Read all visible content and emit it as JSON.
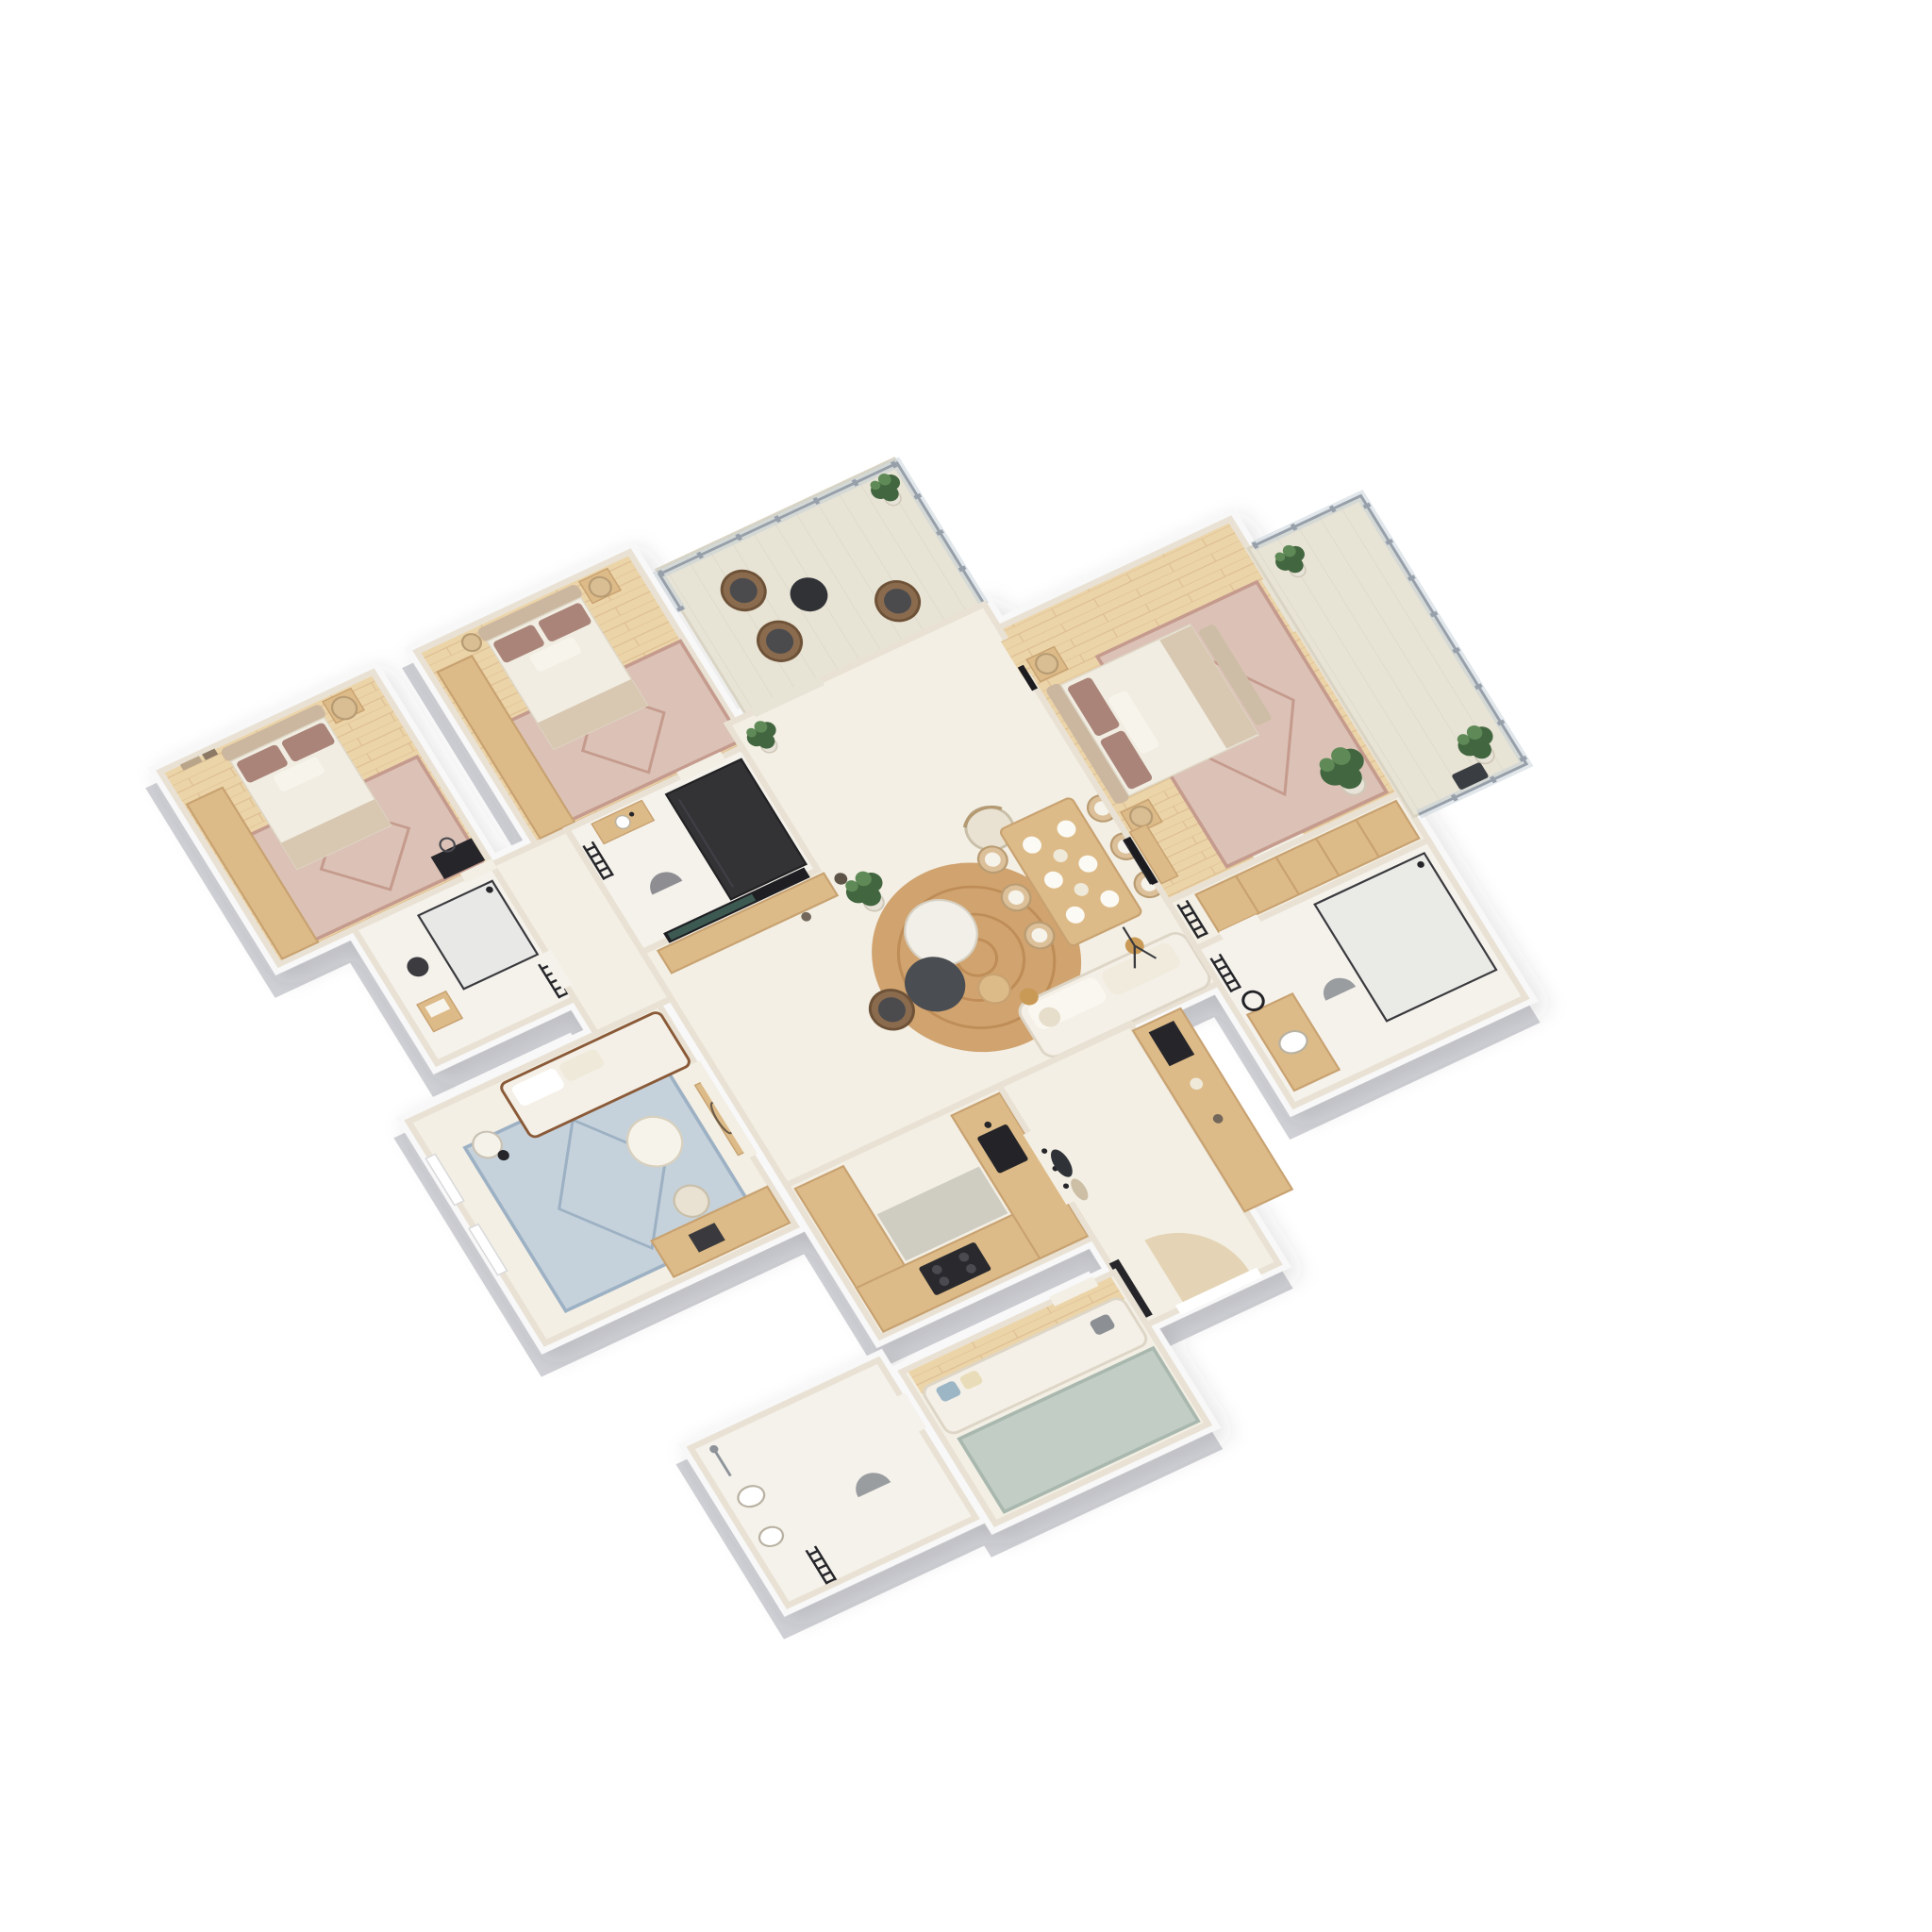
{
  "meta": {
    "title": "3D floor plan — three-bedroom apartment (isometric render)",
    "type": "architectural visualization",
    "style": "photoreal 3D cutaway floor plan on white background",
    "text_labels": []
  },
  "colors": {
    "page": "#ffffff",
    "wall": "#f8f8f9",
    "wallSide": "#d0d1d6",
    "wallFace": "#e9e2d4",
    "floor": "#f3efe4",
    "bathFloor": "#f5f2ec",
    "wood": "#ecd4a9",
    "woodLine": "#ddbf92",
    "counter": "#ddbb88",
    "counterSide": "#c8a271",
    "counterLow": "#cfccc2",
    "rugPink": "#dcc2b6",
    "rugPinkDeep": "#c59b8e",
    "rugBlue": "#c6d2db",
    "rugBlueDeep": "#9db1c4",
    "rugSage": "#c2cdc6",
    "rugSageDeep": "#a9b8af",
    "jute": "#d0a36f",
    "juteDeep": "#bf8d57",
    "sofa": "#f4f0e7",
    "sofaEdge": "#ddd5c6",
    "bedWhite": "#f1ede2",
    "bedBeige": "#d8c8b2",
    "headboard": "#cbb79f",
    "pillow": "#aa8478",
    "dark": "#26262a",
    "railing": "#97a0aa",
    "railGlass": "#c3cfd7",
    "plant": "#42663f",
    "plantLight": "#5f8a57",
    "balcony": "#e7e3d5",
    "balconyLine": "#d9d4c4",
    "doorArc": "#dcc49b",
    "chairTan": "#dcc09a",
    "wicker": "#8a6b4e",
    "cushionDark": "#4b4b4e",
    "brass": "#c99a56",
    "tvScreen": "#3d5a52"
  },
  "stats": {
    "bedrooms": 3,
    "bathrooms": 3,
    "balconies": 2,
    "floors_shown": 1
  },
  "rooms": [
    {
      "id": "bedroom-1",
      "name": "Bedroom 1",
      "floor": "wood",
      "furniture": [
        "wardrobe",
        "double bed with mauve pillows",
        "oriental rug",
        "nightstand",
        "drum pendant lamp",
        "wall art",
        "dark vanity with mirror"
      ]
    },
    {
      "id": "bathroom-1",
      "name": "Bathroom 1",
      "floor": "tile",
      "furniture": [
        "glass walk-in shower",
        "towel ladder",
        "wooden stool with towels",
        "round mat"
      ]
    },
    {
      "id": "home-office",
      "name": "Home office",
      "floor": "cream",
      "furniture": [
        "daybed sofa",
        "blue oriental rug",
        "round coffee table",
        "floor lamp",
        "desk with laptop",
        "office chair",
        "console with mirror",
        "windows"
      ]
    },
    {
      "id": "bedroom-2",
      "name": "Bedroom 2",
      "floor": "wood",
      "furniture": [
        "wardrobe",
        "double bed with mauve pillows",
        "oriental rug",
        "nightstand",
        "drum pendant lamps"
      ]
    },
    {
      "id": "bathroom-2",
      "name": "Bathroom 2",
      "floor": "tile",
      "furniture": [
        "dark glass shower cabin",
        "vanity sink",
        "towel ladder",
        "round mat"
      ]
    },
    {
      "id": "balcony-1",
      "name": "Balcony 1",
      "floor": "decking",
      "furniture": [
        "metal railing",
        "two wicker armchairs",
        "extra wicker chair",
        "round black side table",
        "potted plant"
      ]
    },
    {
      "id": "living-room",
      "name": "Living / dining room",
      "floor": "cream",
      "furniture": [
        "TV console with landscape TV",
        "decor vases",
        "fiddle-leaf fig plants",
        "round jute rug",
        "white sofa",
        "marble coffee table",
        "charcoal coffee table",
        "wood side table",
        "brass side table",
        "lounge armchair",
        "wicker armchair",
        "tripod floor lamp",
        "dining table for six",
        "six dining chairs",
        "table settings",
        "wall art"
      ]
    },
    {
      "id": "kitchen",
      "name": "Kitchen",
      "floor": "cream",
      "furniture": [
        "U-shaped oak counter",
        "lower prep top",
        "cooktop",
        "black sink"
      ]
    },
    {
      "id": "entry-hall",
      "name": "Entry hall",
      "floor": "cream",
      "furniture": [
        "front door with swing arc",
        "black door leaf",
        "coat hooks with jacket and bag",
        "oak sideboard",
        "black appliance"
      ]
    },
    {
      "id": "tv-snug",
      "name": "TV snug",
      "floor": "cream + wood strip",
      "furniture": [
        "white sofa with blue, cream and gray pillows",
        "sage rug"
      ]
    },
    {
      "id": "bathroom-3",
      "name": "Bathroom 3",
      "floor": "tile",
      "furniture": [
        "wall shower set",
        "washbasin",
        "bidet",
        "black towel radiator",
        "half-round mat"
      ]
    },
    {
      "id": "master-bedroom",
      "name": "Master bedroom",
      "floor": "wood",
      "furniture": [
        "double bed with mauve pillows",
        "bench blanket",
        "two nightstands",
        "drum pendant lamps",
        "wall TV",
        "media bench",
        "oriental rug",
        "large fiddle-leaf fig",
        "wall art"
      ]
    },
    {
      "id": "walk-in-closet",
      "name": "Walk-in closet",
      "floor": "cream",
      "furniture": [
        "wardrobe run",
        "striped towel ladder"
      ]
    },
    {
      "id": "master-bathroom",
      "name": "Master bathroom",
      "floor": "tile",
      "furniture": [
        "glass shower",
        "wood vanity with basin",
        "round black mirror",
        "towel ladder",
        "half-round mat"
      ]
    },
    {
      "id": "balcony-2",
      "name": "Balcony 2",
      "floor": "decking",
      "furniture": [
        "glass railing",
        "two potted plants",
        "dark mat"
      ]
    },
    {
      "id": "hallway",
      "name": "Hallway",
      "floor": "cream",
      "furniture": [
        "door openings to bedrooms and bathrooms"
      ]
    }
  ]
}
